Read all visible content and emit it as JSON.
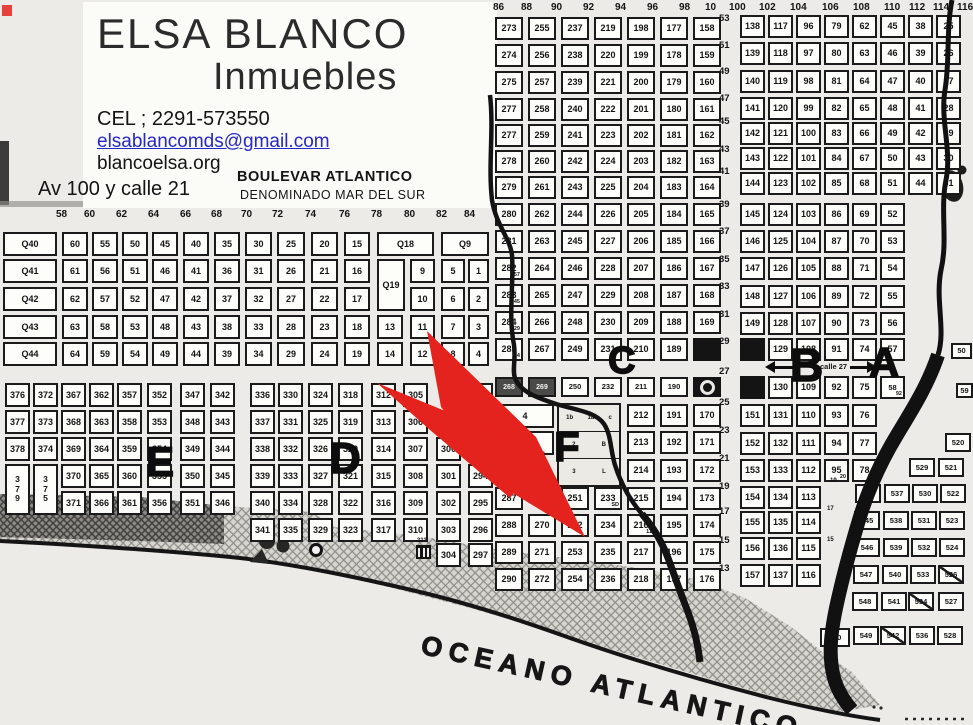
{
  "header": {
    "title1": "ELSA BLANCO",
    "title2": "Inmuebles",
    "phone": "CEL ; 2291-573550",
    "email": "elsablancomds@gmail.com",
    "web": "blancoelsa.org",
    "address": "Av 100 y calle 21",
    "boulevard": "BOULEVAR ATLANTICO",
    "boulevard2": "DENOMINADO MAR DEL SUR"
  },
  "ocean_label": "OCEANO ATLANTICO",
  "calle27_label": "calle 27",
  "colors": {
    "arrow_red": "#e5231e",
    "ink": "#141414"
  },
  "left_grid": {
    "col_headers": [
      "58",
      "60",
      "62",
      "64",
      "66",
      "68",
      "70",
      "72",
      "74",
      "76",
      "78",
      "80",
      "82",
      "84"
    ],
    "rows": [
      [
        "Q40",
        "60",
        "55",
        "50",
        "45",
        "40",
        "35",
        "30",
        "25",
        "20",
        "15",
        "Q18",
        "Q9"
      ],
      [
        "Q41",
        "61",
        "56",
        "51",
        "46",
        "41",
        "36",
        "31",
        "26",
        "21",
        "16",
        "Q19",
        "9",
        "5",
        "1"
      ],
      [
        "Q42",
        "62",
        "57",
        "52",
        "47",
        "42",
        "37",
        "32",
        "27",
        "22",
        "17",
        "10",
        "6",
        "2"
      ],
      [
        "Q43",
        "63",
        "58",
        "53",
        "48",
        "43",
        "38",
        "33",
        "28",
        "23",
        "18",
        "13",
        "11",
        "7",
        "3"
      ],
      [
        "Q44",
        "64",
        "59",
        "54",
        "49",
        "44",
        "39",
        "34",
        "29",
        "24",
        "19",
        "14",
        "12",
        "8",
        "4"
      ]
    ]
  },
  "midleft_grid": {
    "rows": [
      [
        "376",
        "372",
        "367",
        "362",
        "357",
        "352",
        "347",
        "342",
        "336",
        "330",
        "324",
        "318",
        "312",
        "305",
        "",
        "292"
      ],
      [
        "377",
        "373",
        "368",
        "363",
        "358",
        "353",
        "348",
        "343",
        "337",
        "331",
        "325",
        "319",
        "313",
        "306",
        "",
        "293"
      ],
      [
        "378",
        "374",
        "369",
        "364",
        "359",
        "354",
        "349",
        "344",
        "338",
        "332",
        "326",
        "320",
        "314",
        "307",
        "300",
        ""
      ],
      [
        "v379",
        "v375",
        "370",
        "365",
        "360",
        "355",
        "350",
        "345",
        "339",
        "333",
        "327",
        "321",
        "315",
        "308",
        "301",
        "294"
      ],
      [
        "",
        "",
        "371",
        "366",
        "361",
        "356",
        "351",
        "346",
        "340",
        "334",
        "328",
        "322",
        "316",
        "309",
        "302",
        "295"
      ],
      [
        "",
        "",
        "",
        "",
        "",
        "",
        "",
        "",
        "341",
        "335",
        "329",
        "323",
        "317",
        "310",
        "303",
        "296"
      ],
      [
        "",
        "",
        "",
        "",
        "",
        "",
        "",
        "",
        "",
        "",
        "",
        "",
        "",
        "",
        "304",
        "297"
      ]
    ],
    "icon_label": "311"
  },
  "center_grid": {
    "col_headers": [
      "86",
      "88",
      "90",
      "92",
      "94",
      "96",
      "98",
      "10"
    ],
    "row_labels": [
      "53",
      "51",
      "49",
      "47",
      "45",
      "43",
      "41",
      "39",
      "37",
      "35",
      "33",
      "31",
      "29",
      "27",
      "25",
      "23",
      "21",
      "19",
      "17",
      "15",
      "13"
    ],
    "cols": [
      [
        "273",
        "274",
        "275",
        "277",
        "277",
        "278",
        "279",
        "280",
        "281",
        "282|57",
        "283|45",
        "284|29",
        "285|14",
        "268",
        "",
        "",
        "",
        "287",
        "288",
        "289",
        "290"
      ],
      [
        "255",
        "256",
        "257",
        "258",
        "259",
        "260",
        "261",
        "262",
        "263",
        "264",
        "265",
        "266",
        "267",
        "269",
        "",
        "",
        "",
        "",
        "270",
        "271",
        "272"
      ],
      [
        "237",
        "238",
        "239",
        "240",
        "241",
        "242",
        "243",
        "244",
        "245",
        "246",
        "247",
        "248",
        "249",
        "250",
        "",
        "",
        "",
        "251",
        "252",
        "253",
        "254"
      ],
      [
        "219",
        "220",
        "221",
        "222",
        "223",
        "224",
        "225",
        "226",
        "227",
        "228",
        "229",
        "230",
        "231",
        "232",
        "",
        "",
        "",
        "233|SD",
        "234",
        "235",
        "236"
      ],
      [
        "198",
        "199",
        "200",
        "201",
        "202",
        "203",
        "204",
        "205",
        "206",
        "207",
        "208",
        "209",
        "210",
        "211",
        "212",
        "213",
        "214",
        "215",
        "216|11",
        "217",
        "218"
      ],
      [
        "177",
        "178",
        "179",
        "180",
        "181",
        "182",
        "183",
        "184",
        "185",
        "186",
        "187",
        "188",
        "189",
        "190",
        "191",
        "192",
        "193",
        "194",
        "195",
        "196",
        "197"
      ],
      [
        "158",
        "159",
        "160",
        "161",
        "162",
        "163",
        "164",
        "165",
        "166",
        "167",
        "168",
        "169",
        "#",
        "◉",
        "170",
        "171",
        "172",
        "173",
        "174",
        "175",
        "176"
      ]
    ],
    "wide_cells": [
      "4",
      "5"
    ],
    "fblock_rows": [
      [
        "1b",
        "1a",
        "c"
      ],
      [
        "2",
        "B"
      ],
      [
        "3",
        "L"
      ]
    ]
  },
  "right_grid": {
    "col_headers": [
      "100",
      "102",
      "104",
      "106",
      "108",
      "110",
      "112",
      "114",
      "116"
    ],
    "cols": [
      [
        "138",
        "139",
        "140",
        "141",
        "142",
        "143",
        "144",
        "145",
        "146",
        "147",
        "148",
        "149",
        "#",
        "#",
        "151",
        "152",
        "153",
        "154",
        "155",
        "156",
        "157"
      ],
      [
        "117",
        "118",
        "119",
        "120",
        "121",
        "122",
        "123",
        "124",
        "125",
        "126",
        "127",
        "128",
        "129",
        "130",
        "131",
        "132",
        "133",
        "134",
        "135",
        "136",
        "137"
      ],
      [
        "96",
        "97",
        "98",
        "99",
        "100",
        "101",
        "102",
        "103",
        "104",
        "105",
        "106",
        "107",
        "108",
        "109",
        "110",
        "111",
        "112",
        "113",
        "114",
        "115",
        "116"
      ],
      [
        "79",
        "80",
        "81",
        "82",
        "83",
        "84",
        "85",
        "86",
        "87",
        "88",
        "89",
        "90",
        "91",
        "92",
        "93",
        "94",
        "95|20",
        "",
        "",
        "",
        ""
      ],
      [
        "62",
        "63",
        "64",
        "65",
        "66",
        "67",
        "68",
        "69",
        "70",
        "71",
        "72",
        "73",
        "74",
        "75",
        "76",
        "77",
        "78|30",
        "",
        "",
        "",
        ""
      ],
      [
        "45",
        "46",
        "47",
        "48",
        "49",
        "50",
        "51",
        "52",
        "53",
        "54",
        "55",
        "56",
        "57",
        "58|92",
        "",
        "",
        "",
        "",
        "",
        "",
        ""
      ],
      [
        "38",
        "39",
        "40",
        "41",
        "42",
        "43",
        "44",
        "",
        "",
        "",
        "",
        "",
        "",
        "",
        "",
        "",
        "",
        "",
        "",
        "",
        ""
      ],
      [
        "25",
        "26",
        "27",
        "28",
        "29",
        "30",
        "31",
        "",
        "",
        "",
        "",
        "",
        "",
        "",
        "",
        "",
        "",
        "",
        "",
        "",
        ""
      ]
    ],
    "edge_stubs": [
      "50",
      "59"
    ]
  },
  "block_520": {
    "rows": [
      [
        "520"
      ],
      [
        "529",
        "521"
      ],
      [
        "544",
        "537",
        "530",
        "522"
      ],
      [
        "545",
        "538",
        "531",
        "523"
      ],
      [
        "546",
        "539",
        "532",
        "524"
      ],
      [
        "547",
        "540",
        "533",
        "526*"
      ],
      [
        "548",
        "541",
        "534*",
        "527"
      ],
      [
        "550",
        "549",
        "542*",
        "536",
        "528"
      ]
    ]
  },
  "district_letters": [
    "E",
    "D",
    "C",
    "F",
    "B",
    "A"
  ],
  "tiny_labels": [
    "19",
    "17",
    "15"
  ]
}
